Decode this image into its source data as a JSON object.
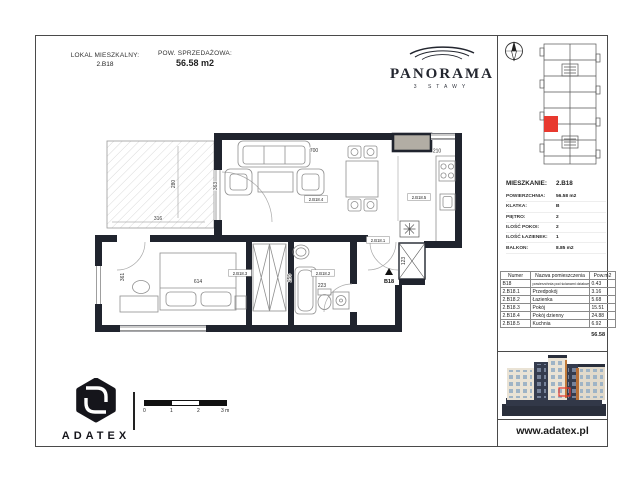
{
  "header": {
    "lokal_label": "LOKAL MIESZKALNY:",
    "lokal_value": "2.B18",
    "pow_label": "POW. SPRZEDAŻOWA:",
    "pow_value": "56.58 m2",
    "brand_name": "PANORAMA",
    "brand_subtitle": "3 STAWY"
  },
  "sidebar": {
    "apartment_label": "MIESZKANIE:",
    "apartment_value": "2.B18",
    "details": [
      {
        "label": "POWIERZCHNIA:",
        "value": "56.58 m2"
      },
      {
        "label": "KLATKA:",
        "value": "B"
      },
      {
        "label": "PIĘTRO:",
        "value": "2"
      },
      {
        "label": "ILOŚĆ POKOI:",
        "value": "2"
      },
      {
        "label": "ILOŚĆ ŁAZIENEK:",
        "value": "1"
      },
      {
        "label": "BALKON:",
        "value": "8.85 m2"
      }
    ],
    "table": {
      "headers": [
        "Numer",
        "Nazwa pomieszczenia",
        "Pow.m2"
      ],
      "rows": [
        {
          "numer": "B18",
          "nazwa": "powierzchnia pod ścianami działowymi",
          "pow": "0.43"
        },
        {
          "numer": "2.B18.1",
          "nazwa": "Przedpokój",
          "pow": "3.16"
        },
        {
          "numer": "2.B18.2",
          "nazwa": "Łazienka",
          "pow": "5.68"
        },
        {
          "numer": "2.B18.3",
          "nazwa": "Pokój",
          "pow": "15.51"
        },
        {
          "numer": "2.B18.4",
          "nazwa": "Pokój dzienny",
          "pow": "24.88"
        },
        {
          "numer": "2.B18.5",
          "nazwa": "Kuchnia",
          "pow": "6.92"
        }
      ],
      "total": "56.58"
    },
    "website": "www.adatex.pl"
  },
  "footer": {
    "logo_text": "ADATEX",
    "scale_ticks": [
      "0",
      "1",
      "2",
      "3 m"
    ]
  },
  "plan": {
    "rooms": {
      "hall": "2.B18.1",
      "bath": "2.B18.2",
      "bedroom": "2.B18.3",
      "living": "2.B18.4",
      "kitchen": "2.B18.5"
    },
    "entrance": "B18",
    "dims": {
      "living_width": "700",
      "living_depth": "363",
      "kitchen_width": "210",
      "balcony_width": "316",
      "balcony_depth": "280",
      "bedroom_width": "614",
      "bedroom_depth": "361",
      "bath_width": "223",
      "bath_depth": "255",
      "shaft": "123"
    }
  },
  "colors": {
    "accent_red": "#e8392f",
    "wall_dark": "#20242e",
    "shaft_gray": "#b2ada4"
  }
}
